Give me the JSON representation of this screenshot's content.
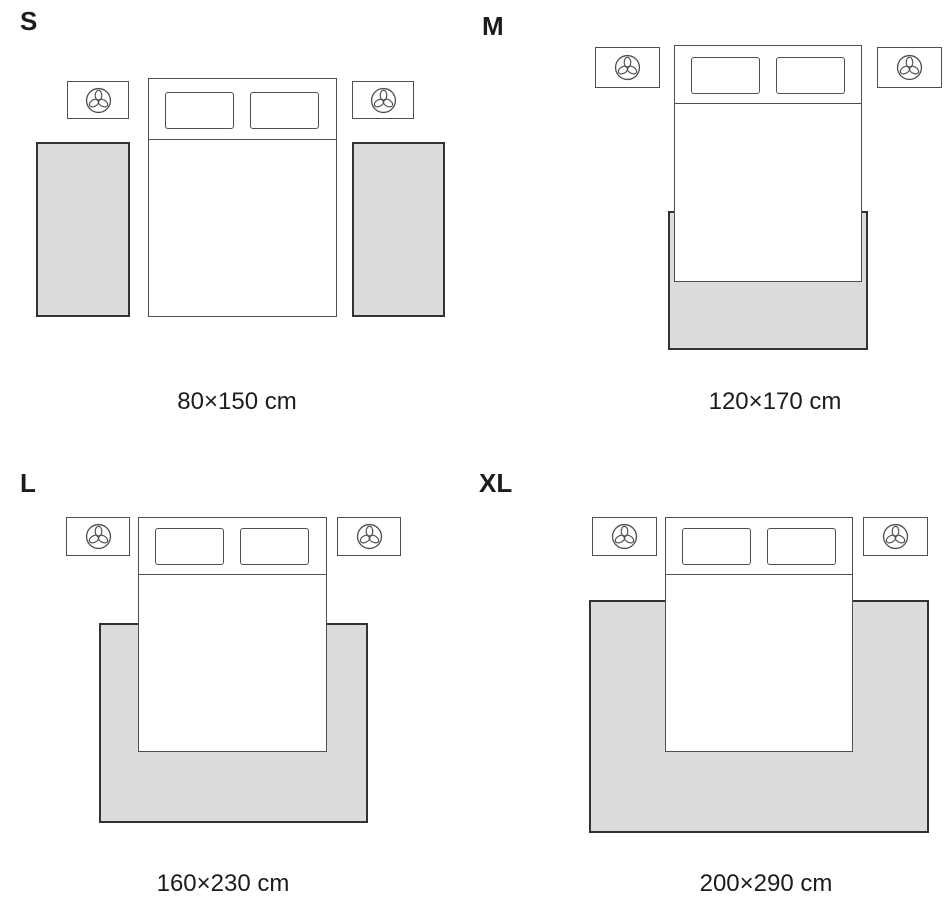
{
  "colors": {
    "background": "#ffffff",
    "rug_fill": "#dcdcdc",
    "rug_border": "#333333",
    "furniture_line": "#4f4f4f",
    "text": "#1c1c1c"
  },
  "icons": {
    "nightstand_decor": "plant-icon"
  },
  "panels": [
    {
      "size": "S",
      "caption": "80×150 cm",
      "rug_arrangement": "two runner rugs, one along each side of the bed"
    },
    {
      "size": "M",
      "caption": "120×170 cm",
      "rug_arrangement": "rug under the foot end of the bed"
    },
    {
      "size": "L",
      "caption": "160×230 cm",
      "rug_arrangement": "rug under the lower part of the bed, extending on three sides"
    },
    {
      "size": "XL",
      "caption": "200×290 cm",
      "rug_arrangement": "large rug under the bed, extending widely on three sides"
    }
  ]
}
